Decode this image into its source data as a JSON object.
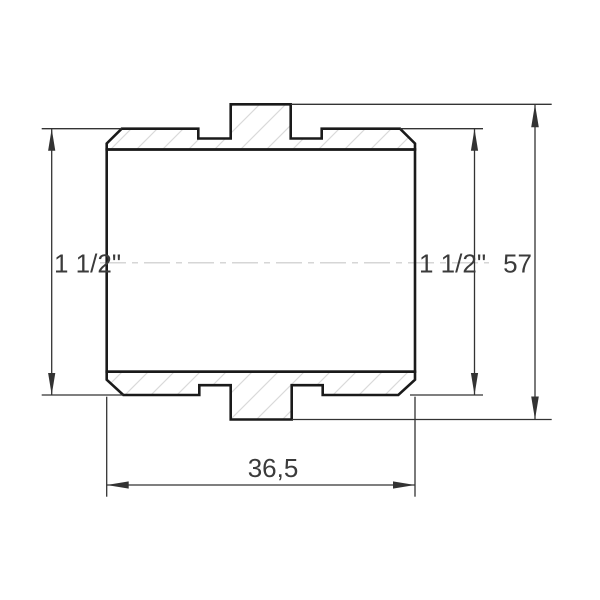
{
  "drawing": {
    "type": "technical-drawing",
    "subject": "threaded pipe nipple coupling, side section view",
    "dimensions": {
      "left_thread": "1 1/2\"",
      "right_thread": "1 1/2\"",
      "overall_length": "57",
      "body_width": "36,5"
    },
    "colors": {
      "background": "#ffffff",
      "outline": "#1a1a1a",
      "dimension_lines": "#333333",
      "hatch": "#dadada",
      "centerline": "#c9c9c9",
      "text": "#3b3b3b"
    }
  }
}
